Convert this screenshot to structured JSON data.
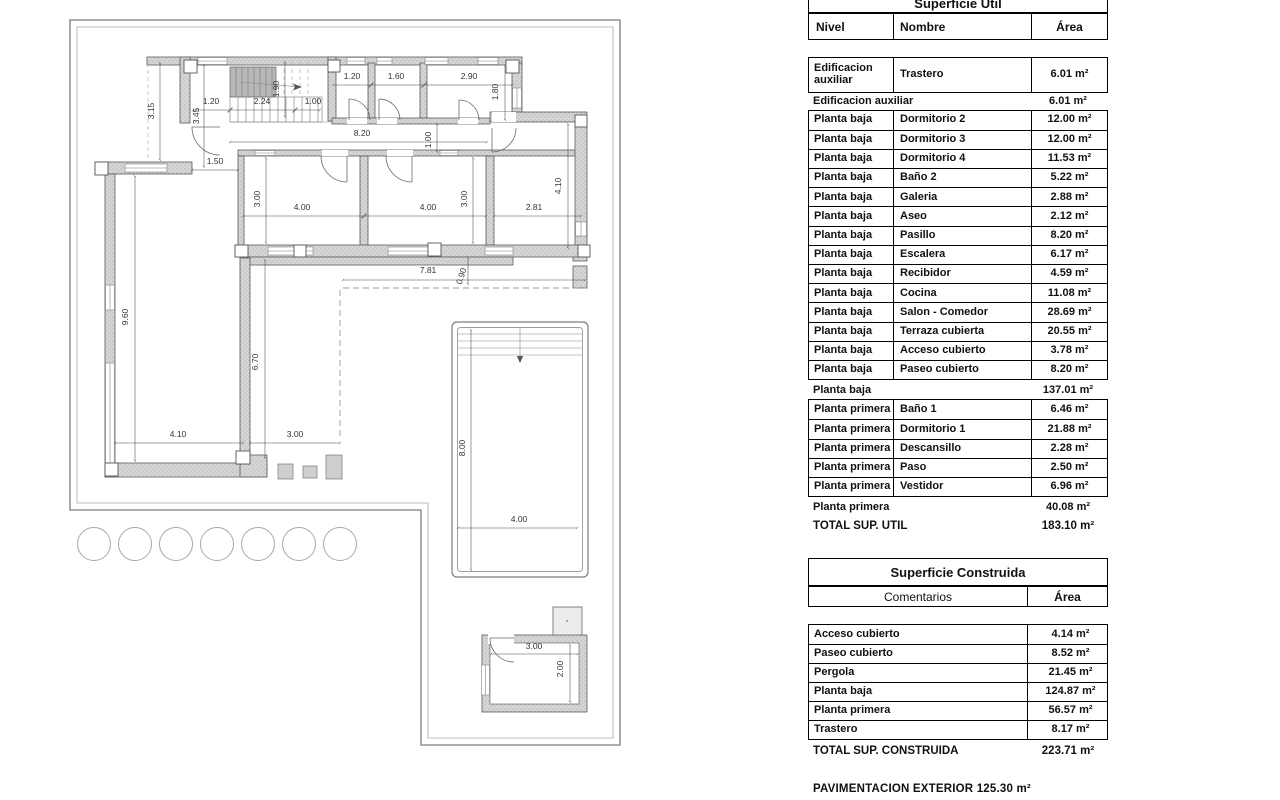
{
  "plan": {
    "dimensions": [
      {
        "t": "3.15",
        "x": 154,
        "y": 111,
        "r": -90
      },
      {
        "t": "1.20",
        "x": 211,
        "y": 104,
        "r": 0
      },
      {
        "t": "2.24",
        "x": 262,
        "y": 104,
        "r": 0
      },
      {
        "t": "1.00",
        "x": 313,
        "y": 104,
        "r": 0
      },
      {
        "t": "3.45",
        "x": 199,
        "y": 116,
        "r": -90
      },
      {
        "t": "1.90",
        "x": 279,
        "y": 89,
        "r": -90
      },
      {
        "t": "1.20",
        "x": 352,
        "y": 79,
        "r": 0
      },
      {
        "t": "1.60",
        "x": 396,
        "y": 79,
        "r": 0
      },
      {
        "t": "2.90",
        "x": 469,
        "y": 79,
        "r": 0
      },
      {
        "t": "1.80",
        "x": 498,
        "y": 92,
        "r": -90
      },
      {
        "t": "8.20",
        "x": 362,
        "y": 136,
        "r": 0
      },
      {
        "t": "1.00",
        "x": 431,
        "y": 140,
        "r": -90
      },
      {
        "t": "1.50",
        "x": 215,
        "y": 164,
        "r": 0
      },
      {
        "t": "3.00",
        "x": 260,
        "y": 199,
        "r": -90
      },
      {
        "t": "4.00",
        "x": 302,
        "y": 210,
        "r": 0
      },
      {
        "t": "4.00",
        "x": 428,
        "y": 210,
        "r": 0
      },
      {
        "t": "3.00",
        "x": 467,
        "y": 199,
        "r": -90
      },
      {
        "t": "2.81",
        "x": 534,
        "y": 210,
        "r": 0
      },
      {
        "t": "4.10",
        "x": 561,
        "y": 186,
        "r": -90
      },
      {
        "t": "9.60",
        "x": 128,
        "y": 317,
        "r": -90
      },
      {
        "t": "6.70",
        "x": 258,
        "y": 362,
        "r": -90
      },
      {
        "t": "4.10",
        "x": 178,
        "y": 437,
        "r": 0
      },
      {
        "t": "3.00",
        "x": 295,
        "y": 437,
        "r": 0
      },
      {
        "t": "7.81",
        "x": 428,
        "y": 273,
        "r": 0
      },
      {
        "t": "0.90",
        "x": 464,
        "y": 277,
        "r": -72
      },
      {
        "t": "8.00",
        "x": 465,
        "y": 448,
        "r": -90
      },
      {
        "t": "4.00",
        "x": 519,
        "y": 522,
        "r": 0
      },
      {
        "t": "3.00",
        "x": 534,
        "y": 649,
        "r": 0
      },
      {
        "t": "2.00",
        "x": 563,
        "y": 669,
        "r": -90
      }
    ]
  },
  "sup_util": {
    "title": "Superficie Util",
    "headers": [
      "Nivel",
      "Nombre",
      "Área"
    ],
    "groups": [
      {
        "rows": [
          [
            "Edificacion auxiliar",
            "Trastero",
            "6.01 m²"
          ]
        ],
        "subtotal": [
          "Edificacion auxiliar",
          "6.01 m²"
        ]
      },
      {
        "rows": [
          [
            "Planta baja",
            "Dormitorio 2",
            "12.00 m²"
          ],
          [
            "Planta baja",
            "Dormitorio 3",
            "12.00 m²"
          ],
          [
            "Planta baja",
            "Dormitorio 4",
            "11.53 m²"
          ],
          [
            "Planta baja",
            "Baño 2",
            "5.22 m²"
          ],
          [
            "Planta baja",
            "Galeria",
            "2.88 m²"
          ],
          [
            "Planta baja",
            "Aseo",
            "2.12 m²"
          ],
          [
            "Planta baja",
            "Pasillo",
            "8.20 m²"
          ],
          [
            "Planta baja",
            "Escalera",
            "6.17 m²"
          ],
          [
            "Planta baja",
            "Recibidor",
            "4.59 m²"
          ],
          [
            "Planta baja",
            "Cocina",
            "11.08 m²"
          ],
          [
            "Planta baja",
            "Salon - Comedor",
            "28.69 m²"
          ],
          [
            "Planta baja",
            "Terraza cubierta",
            "20.55 m²"
          ],
          [
            "Planta baja",
            "Acceso cubierto",
            "3.78 m²"
          ],
          [
            "Planta baja",
            "Paseo cubierto",
            "8.20 m²"
          ]
        ],
        "subtotal": [
          "Planta baja",
          "137.01 m²"
        ]
      },
      {
        "rows": [
          [
            "Planta primera",
            "Baño 1",
            "6.46 m²"
          ],
          [
            "Planta primera",
            "Dormitorio 1",
            "21.88 m²"
          ],
          [
            "Planta primera",
            "Descansillo",
            "2.28 m²"
          ],
          [
            "Planta primera",
            "Paso",
            "2.50 m²"
          ],
          [
            "Planta primera",
            "Vestidor",
            "6.96 m²"
          ]
        ],
        "subtotal": [
          "Planta primera",
          "40.08 m²"
        ]
      }
    ],
    "total": [
      "TOTAL SUP. UTIL",
      "183.10 m²"
    ]
  },
  "sup_construida": {
    "title": "Superficie Construida",
    "headers": [
      "Comentarios",
      "Área"
    ],
    "rows": [
      [
        "Acceso cubierto",
        "4.14 m²"
      ],
      [
        "Paseo cubierto",
        "8.52 m²"
      ],
      [
        "Pergola",
        "21.45 m²"
      ],
      [
        "Planta baja",
        "124.87 m²"
      ],
      [
        "Planta primera",
        "56.57 m²"
      ],
      [
        "Trastero",
        "8.17 m²"
      ]
    ],
    "total": [
      "TOTAL SUP. CONSTRUIDA",
      "223.71 m²"
    ]
  },
  "footer": {
    "pavimentacion": "PAVIMENTACION EXTERIOR 125.30 m²"
  }
}
